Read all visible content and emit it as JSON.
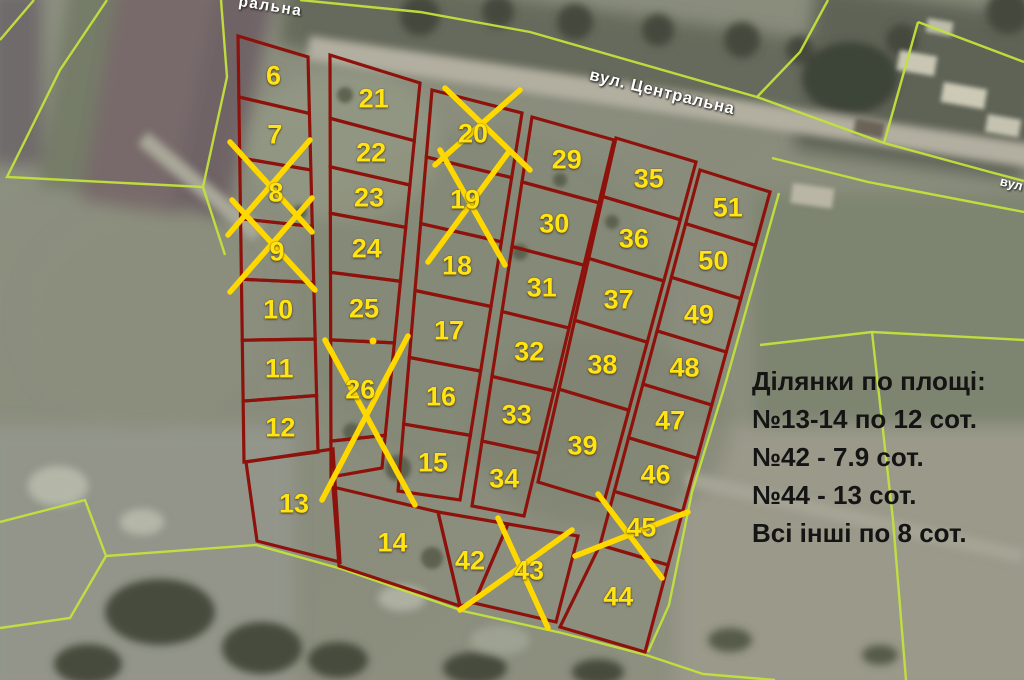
{
  "map": {
    "street_label_main": "вул. Центральна",
    "street_label_partial_top": "ральна",
    "street_label_partial_right": "вул",
    "info_panel": {
      "title": "Ділянки по площі:",
      "lines": [
        "№13-14 по 12 сот.",
        "№42 - 7.9 сот.",
        "№44 - 13 сот.",
        "Всі інші по 8 сот."
      ]
    },
    "colors": {
      "parcel_boundary": "#8e120c",
      "parcel_number": "#ffe312",
      "sold_cross": "#ffd800",
      "field_boundary": "#c3e23c",
      "street_label_text": "#ffffff",
      "info_text": "#141414"
    },
    "sold_parcel_numbers": [
      "8",
      "9",
      "19",
      "20",
      "26",
      "43",
      "45"
    ],
    "columns": [
      {
        "quad": [
          [
            238,
            36
          ],
          [
            308,
            57
          ],
          [
            318,
            452
          ],
          [
            244,
            462
          ]
        ],
        "fractions": [
          0,
          0.143,
          0.286,
          0.429,
          0.571,
          0.714,
          0.857,
          1
        ],
        "parcels": [
          "6",
          "7",
          "8",
          "9",
          "10",
          "11",
          "12"
        ]
      },
      {
        "quad": [
          [
            330,
            55
          ],
          [
            420,
            83
          ],
          [
            382,
            468
          ],
          [
            331,
            477
          ]
        ],
        "fractions": [
          0,
          0.15,
          0.265,
          0.375,
          0.515,
          0.675,
          0.915,
          1
        ],
        "parcels": [
          "21",
          "22",
          "23",
          "24",
          "25",
          "26",
          ""
        ]
      },
      {
        "quad": [
          [
            432,
            90
          ],
          [
            522,
            113
          ],
          [
            460,
            500
          ],
          [
            398,
            491
          ]
        ],
        "fractions": [
          0,
          0.167,
          0.333,
          0.5,
          0.667,
          0.833,
          1
        ],
        "parcels": [
          "20",
          "19",
          "18",
          "17",
          "16",
          "15"
        ]
      },
      {
        "quad": [
          [
            532,
            117
          ],
          [
            614,
            140
          ],
          [
            524,
            516
          ],
          [
            472,
            506
          ]
        ],
        "fractions": [
          0,
          0.167,
          0.333,
          0.5,
          0.667,
          0.833,
          1
        ],
        "parcels": [
          "29",
          "30",
          "31",
          "32",
          "33",
          "34"
        ]
      },
      {
        "quad": [
          [
            616,
            138
          ],
          [
            696,
            162
          ],
          [
            604,
            502
          ],
          [
            538,
            482
          ]
        ],
        "fractions": [
          0,
          0.17,
          0.35,
          0.53,
          0.73,
          1
        ],
        "parcels": [
          "35",
          "36",
          "37",
          "38",
          "39"
        ]
      },
      {
        "quad": [
          [
            700,
            170
          ],
          [
            770,
            192
          ],
          [
            668,
            565
          ],
          [
            600,
            545
          ]
        ],
        "fractions": [
          0,
          0.143,
          0.286,
          0.429,
          0.571,
          0.714,
          0.857,
          1
        ],
        "parcels": [
          "51",
          "50",
          "49",
          "48",
          "47",
          "46",
          "45"
        ]
      }
    ],
    "standalone_parcels": [
      {
        "n": "13",
        "quad": [
          [
            246,
            462
          ],
          [
            333,
            449
          ],
          [
            340,
            562
          ],
          [
            257,
            541
          ]
        ]
      },
      {
        "n": "14",
        "quad": [
          [
            333,
            487
          ],
          [
            438,
            512
          ],
          [
            460,
            606
          ],
          [
            339,
            566
          ]
        ]
      },
      {
        "n": "42",
        "quad": [
          [
            438,
            512
          ],
          [
            508,
            524
          ],
          [
            474,
            603
          ],
          [
            460,
            606
          ]
        ]
      },
      {
        "n": "43",
        "quad": [
          [
            508,
            524
          ],
          [
            578,
            536
          ],
          [
            556,
            622
          ],
          [
            474,
            603
          ]
        ]
      },
      {
        "n": "44",
        "quad": [
          [
            600,
            545
          ],
          [
            668,
            565
          ],
          [
            645,
            652
          ],
          [
            560,
            627
          ]
        ]
      }
    ],
    "crosses": [
      {
        "parcel": "8",
        "lines": [
          [
            230,
            142,
            312,
            232
          ],
          [
            310,
            140,
            228,
            235
          ]
        ]
      },
      {
        "parcel": "9",
        "lines": [
          [
            232,
            200,
            315,
            290
          ],
          [
            312,
            198,
            230,
            292
          ]
        ]
      },
      {
        "parcel": "20",
        "lines": [
          [
            445,
            88,
            530,
            170
          ],
          [
            520,
            90,
            435,
            165
          ]
        ]
      },
      {
        "parcel": "19",
        "lines": [
          [
            440,
            150,
            505,
            265
          ],
          [
            508,
            153,
            428,
            262
          ]
        ]
      },
      {
        "parcel": "26",
        "lines": [
          [
            325,
            340,
            415,
            505
          ],
          [
            408,
            336,
            322,
            500
          ]
        ]
      },
      {
        "parcel": "43",
        "lines": [
          [
            498,
            518,
            548,
            628
          ],
          [
            572,
            530,
            460,
            610
          ]
        ]
      },
      {
        "parcel": "45",
        "lines": [
          [
            598,
            494,
            662,
            578
          ],
          [
            688,
            512,
            575,
            556
          ]
        ]
      }
    ],
    "dot": {
      "x": 373,
      "y": 341,
      "r": 3.5
    },
    "field_lines": [
      [
        [
          34,
          0
        ],
        [
          0,
          40
        ]
      ],
      [
        [
          107,
          0
        ],
        [
          60,
          70
        ],
        [
          7,
          177
        ],
        [
          203,
          187
        ],
        [
          227,
          77
        ],
        [
          221,
          0
        ]
      ],
      [
        [
          203,
          187
        ],
        [
          225,
          255
        ]
      ],
      [
        [
          300,
          0
        ],
        [
          420,
          12
        ],
        [
          530,
          32
        ],
        [
          757,
          97
        ],
        [
          800,
          52
        ],
        [
          828,
          0
        ]
      ],
      [
        [
          757,
          97
        ],
        [
          884,
          143
        ],
        [
          990,
          172
        ],
        [
          1024,
          181
        ]
      ],
      [
        [
          918,
          22
        ],
        [
          884,
          143
        ]
      ],
      [
        [
          918,
          22
        ],
        [
          1024,
          62
        ]
      ],
      [
        [
          772,
          158
        ],
        [
          868,
          182
        ],
        [
          1024,
          212
        ]
      ],
      [
        [
          760,
          345
        ],
        [
          872,
          332
        ],
        [
          1024,
          340
        ]
      ],
      [
        [
          872,
          332
        ],
        [
          893,
          520
        ],
        [
          906,
          680
        ]
      ],
      [
        [
          0,
          522
        ],
        [
          85,
          500
        ],
        [
          106,
          556
        ],
        [
          70,
          618
        ],
        [
          0,
          628
        ]
      ],
      [
        [
          106,
          556
        ],
        [
          256,
          545
        ],
        [
          342,
          569
        ],
        [
          463,
          611
        ],
        [
          562,
          633
        ],
        [
          646,
          655
        ],
        [
          703,
          674
        ],
        [
          775,
          680
        ]
      ],
      [
        [
          779,
          193
        ],
        [
          725,
          385
        ],
        [
          692,
          492
        ],
        [
          669,
          605
        ],
        [
          648,
          652
        ]
      ]
    ]
  }
}
